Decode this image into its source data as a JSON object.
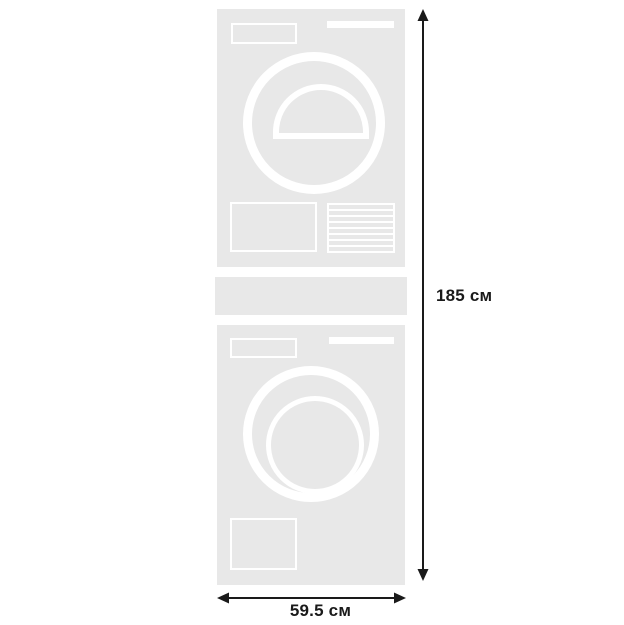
{
  "diagram": {
    "type": "product-dimensions",
    "subject": "stacked-washer-and-dryer",
    "labels": {
      "height": "185 см",
      "width": "59.5 см"
    },
    "units": [
      {
        "id": "dryer",
        "position": "top",
        "details": [
          "display-panel",
          "door-handle-bar",
          "round-door",
          "door-scoop",
          "condenser-panel",
          "vent-grille"
        ]
      },
      {
        "id": "stacking-kit",
        "position": "middle",
        "details": []
      },
      {
        "id": "washer",
        "position": "bottom",
        "details": [
          "display-panel",
          "door-handle-bar",
          "round-door",
          "inner-drum",
          "service-panel"
        ]
      }
    ],
    "colors": {
      "appliance_fill": "#e8e8e8",
      "appliance_detail": "#ffffff",
      "dimension": "#1a1a1a",
      "background": "#ffffff"
    }
  }
}
